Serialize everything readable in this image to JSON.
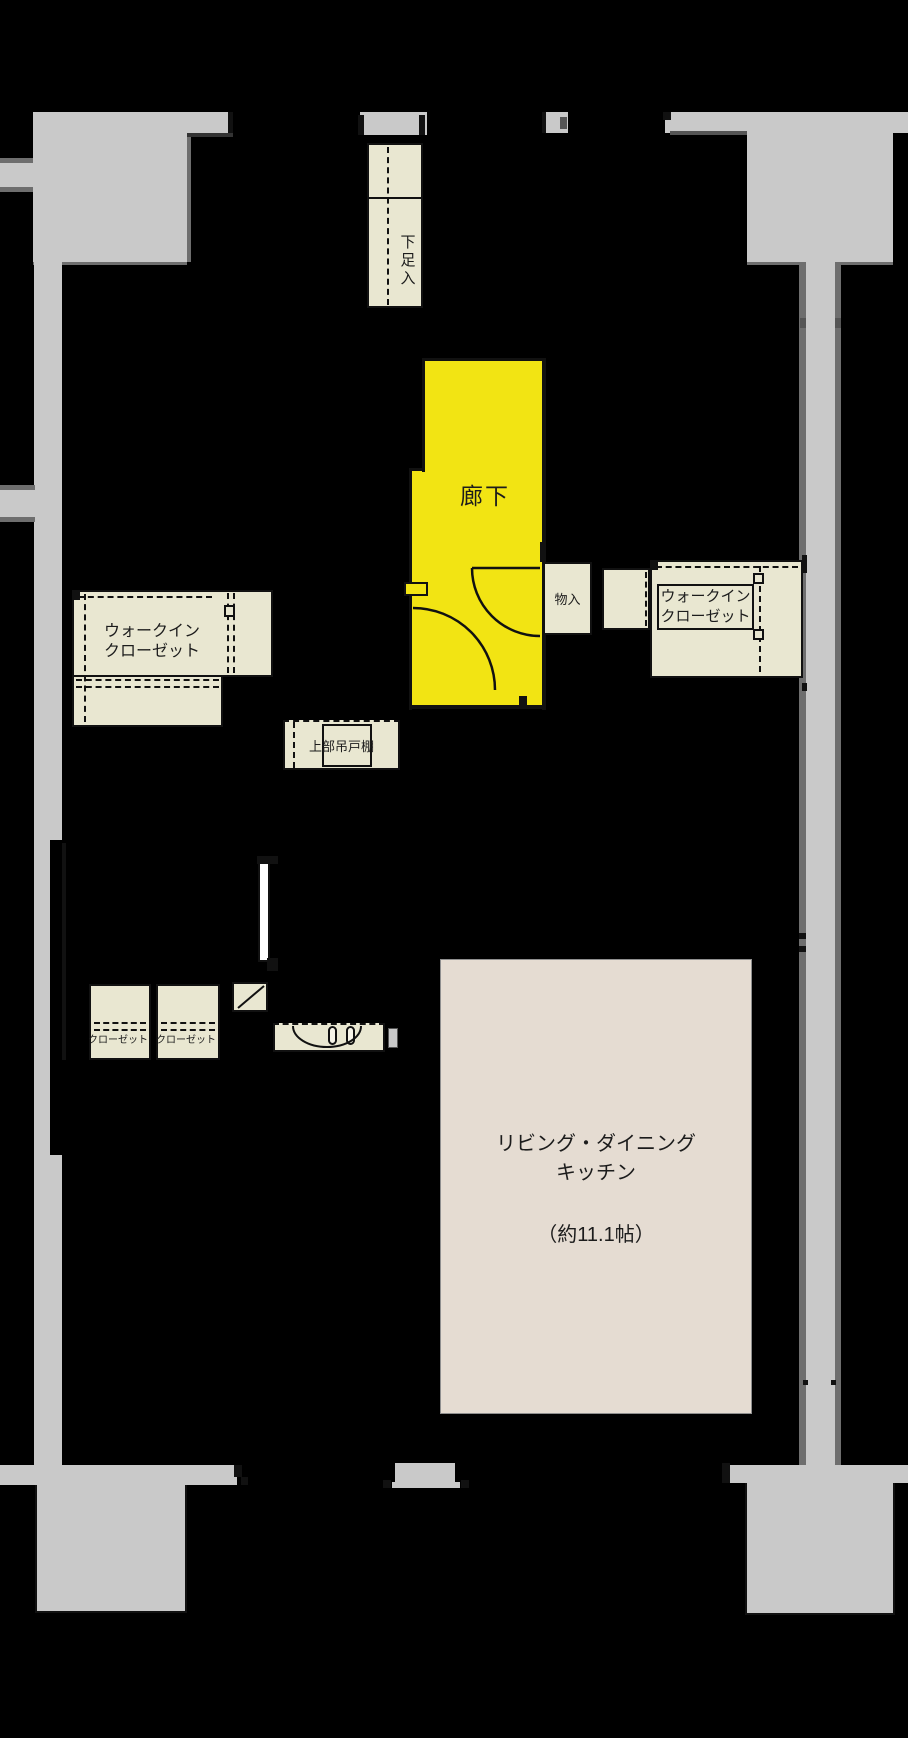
{
  "meta": {
    "kind": "japanese-floor-plan",
    "width_px": 908,
    "height_px": 1738
  },
  "palette": {
    "background": "#000000",
    "wall_gray": "#c9c9c9",
    "wall_gray_dark": "#6e6e6e",
    "outline_black": "#111111",
    "corridor_yellow": "#f2e413",
    "cabinet_cream": "#e9e7d1",
    "ldk_beige": "#e5dcd2",
    "door_white": "#ffffff",
    "text_color": "#1c1c1c"
  },
  "labels": {
    "corridor": "廊下",
    "shoe_cabinet": "下足入",
    "storage": "物入",
    "walkin_left": {
      "line1": "ウォークイン",
      "line2": "クローゼット"
    },
    "walkin_right": {
      "line1": "ウォークイン",
      "line2": "クローゼット"
    },
    "upper_cabinet": "上部吊戸棚",
    "closet_a": "クローゼット",
    "closet_b": "クローゼット",
    "ldk": {
      "line1": "リビング・ダイニング",
      "line2": "キッチン",
      "size": "（約11.1帖）"
    }
  }
}
